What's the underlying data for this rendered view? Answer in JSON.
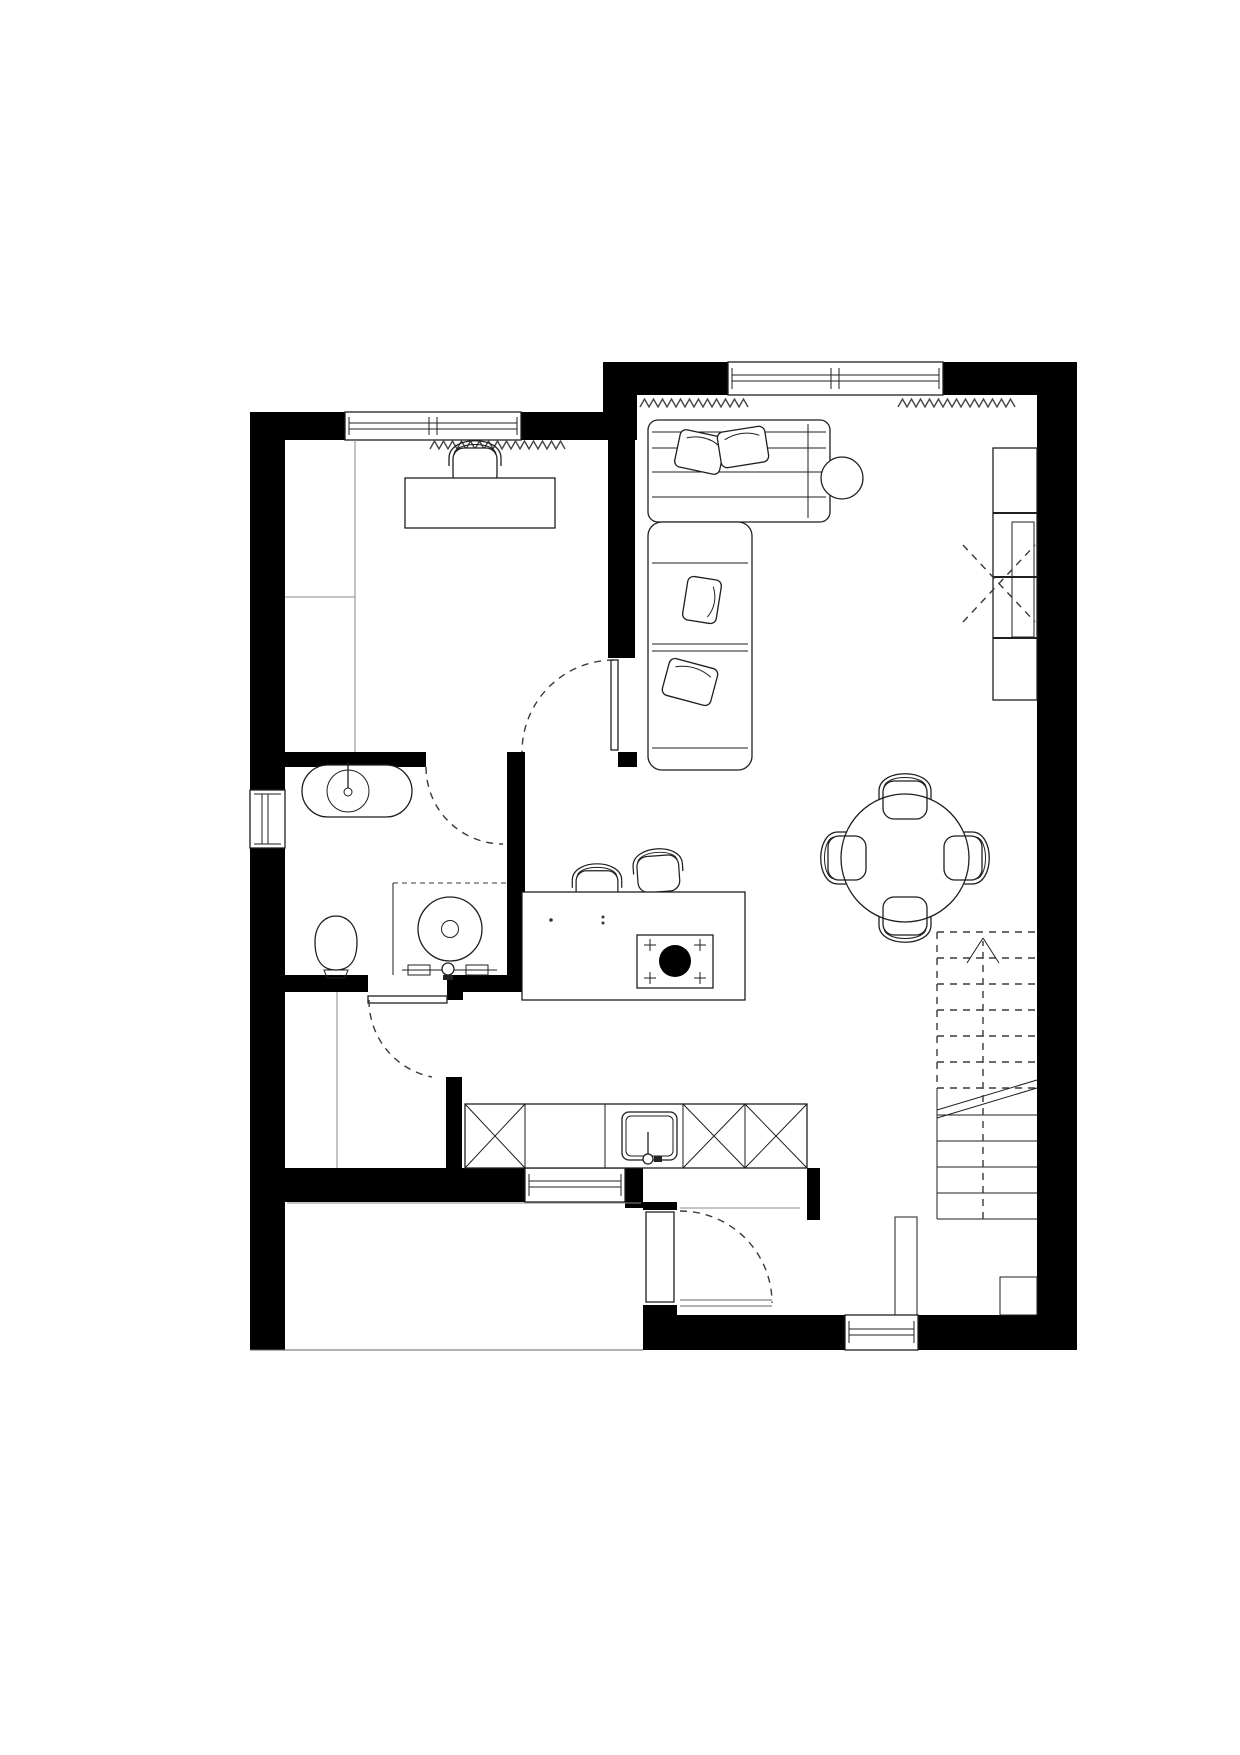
{
  "document": {
    "kind": "architectural-floor-plan",
    "background": "#ffffff",
    "width_px": 1240,
    "height_px": 1755
  },
  "palette": {
    "wall_fill": "#000000",
    "outline": "#1f1f1f",
    "thin_line": "#8a8a8a",
    "dashed_line": "#3a3a3a",
    "paper": "#ffffff"
  },
  "labels": {
    "plan": "ground floor plan",
    "office": "office room",
    "bathroom": "bathroom",
    "hallway": "hallway",
    "storage": "storage room",
    "kitchen": "kitchen",
    "dining": "dining area",
    "living": "living area",
    "entry": "entry",
    "stairs": "staircase up",
    "sofa": "corner sofa",
    "side_table": "side table",
    "shelf": "wall shelf unit",
    "dining_table": "round dining table",
    "chair": "chair",
    "bar_chair": "bar chair",
    "island": "kitchen island with hob",
    "counter": "kitchen base cabinets",
    "counter_sink": "kitchen sink",
    "desk": "desk",
    "desk_chair": "desk chair",
    "basin": "washbasin",
    "toilet": "toilet",
    "washer": "washing machine niche",
    "window": "window",
    "door": "door swing"
  },
  "inventory": {
    "windows": [
      "office-window",
      "living-room-window",
      "bathroom-window",
      "hallway-window",
      "entry-window"
    ],
    "doors": [
      "office-door",
      "bathroom-door",
      "hallway-door",
      "storage-entry-door"
    ],
    "stairs": {
      "direction": "up",
      "dashed_treads": 7,
      "solid_treads": 5,
      "has_break_line": true,
      "has_up_arrow": true
    },
    "dining_chairs": 4,
    "bar_chairs": 2,
    "radiator_zigzags": 3
  }
}
